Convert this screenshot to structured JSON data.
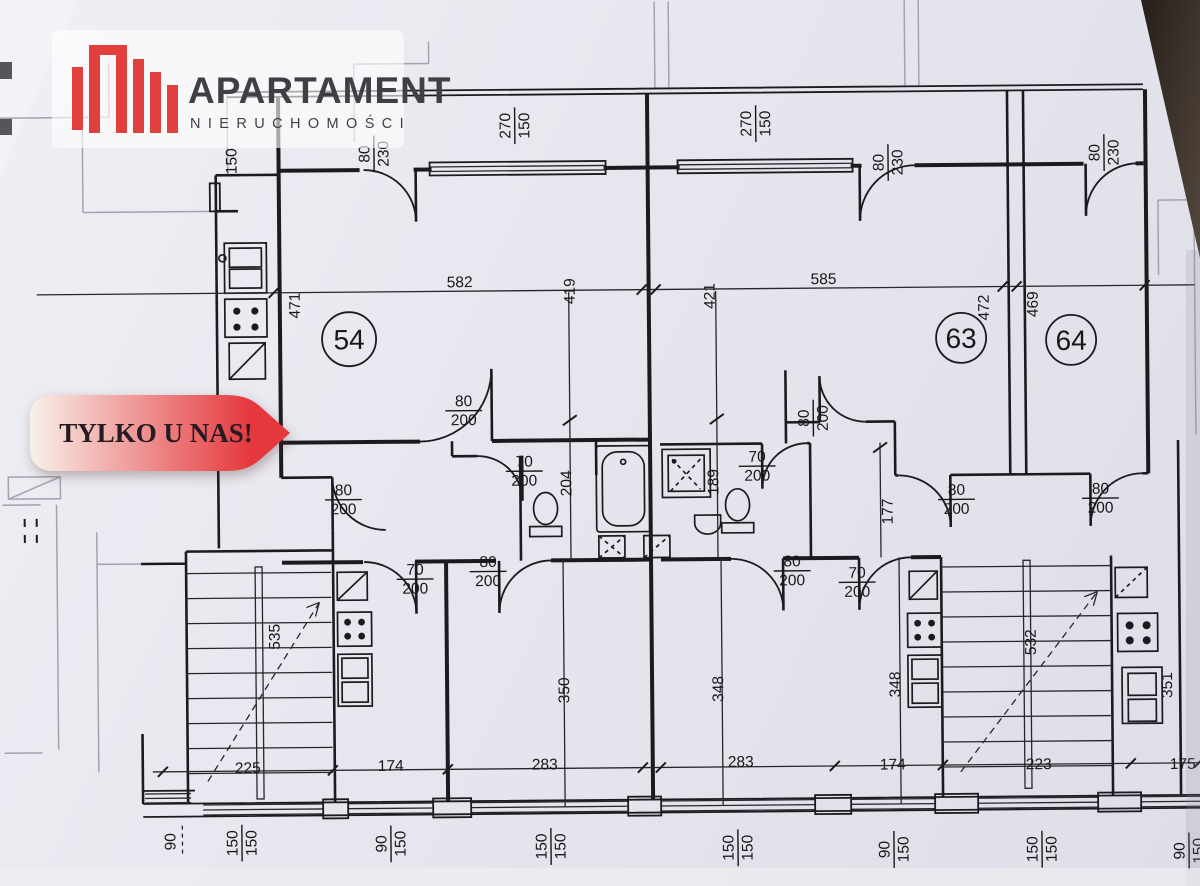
{
  "logo": {
    "title": "APARTAMENT",
    "subtitle": "NIERUCHOMOŚCI",
    "accent_color": "#e2403c",
    "text_color": "#3f3f44"
  },
  "badge": {
    "text": "TYLKO U NAS!",
    "gradient_start": "#f8f0ea",
    "gradient_end": "#e5383d",
    "text_color": "#241c22"
  },
  "rooms": [
    {
      "number": "54"
    },
    {
      "number": "63"
    },
    {
      "number": "64"
    }
  ],
  "ink_color": "#1b1b1f",
  "dimension_labels": [
    {
      "t": "80/230",
      "x": 376,
      "y": 152,
      "r": -90
    },
    {
      "t": "270/150",
      "x": 517,
      "y": 125,
      "r": -90
    },
    {
      "t": "270/150",
      "x": 758,
      "y": 125,
      "r": -90
    },
    {
      "t": "80/230",
      "x": 890,
      "y": 165,
      "r": -90
    },
    {
      "t": "80/230",
      "x": 1106,
      "y": 157,
      "r": -90
    },
    {
      "t": "150",
      "x": 233,
      "y": 158,
      "r": -90
    },
    {
      "t": "471",
      "x": 295,
      "y": 303,
      "r": -90
    },
    {
      "t": "582",
      "x": 461,
      "y": 280,
      "r": 0
    },
    {
      "t": "419",
      "x": 570,
      "y": 291,
      "r": -90
    },
    {
      "t": "421",
      "x": 710,
      "y": 297,
      "r": -90
    },
    {
      "t": "585",
      "x": 825,
      "y": 280,
      "r": 0
    },
    {
      "t": "472",
      "x": 984,
      "y": 311,
      "r": -90
    },
    {
      "t": "469",
      "x": 1033,
      "y": 308,
      "r": -90
    },
    {
      "t": "80/200",
      "x": 464,
      "y": 409,
      "r": 0
    },
    {
      "t": "80/200",
      "x": 813,
      "y": 420,
      "r": -90
    },
    {
      "t": "70/200",
      "x": 524,
      "y": 470,
      "r": 0
    },
    {
      "t": "70/200",
      "x": 757,
      "y": 467,
      "r": 0
    },
    {
      "t": "204",
      "x": 565,
      "y": 483,
      "r": -90
    },
    {
      "t": "189",
      "x": 712,
      "y": 483,
      "r": -90
    },
    {
      "t": "80/200",
      "x": 343,
      "y": 497,
      "r": 0
    },
    {
      "t": "80/200",
      "x": 956,
      "y": 502,
      "r": 0
    },
    {
      "t": "80/200",
      "x": 1100,
      "y": 502,
      "r": 0
    },
    {
      "t": "177",
      "x": 886,
      "y": 514,
      "r": -90
    },
    {
      "t": "70/200",
      "x": 414,
      "y": 577,
      "r": 0
    },
    {
      "t": "80/200",
      "x": 487,
      "y": 570,
      "r": 0
    },
    {
      "t": "80/200",
      "x": 791,
      "y": 572,
      "r": 0
    },
    {
      "t": "70/200",
      "x": 856,
      "y": 584,
      "r": 0
    },
    {
      "t": "535",
      "x": 272,
      "y": 634,
      "r": -90
    },
    {
      "t": "350",
      "x": 561,
      "y": 690,
      "r": -90
    },
    {
      "t": "348",
      "x": 715,
      "y": 690,
      "r": -90
    },
    {
      "t": "348",
      "x": 892,
      "y": 687,
      "r": -90
    },
    {
      "t": "532",
      "x": 1028,
      "y": 646,
      "r": -90
    },
    {
      "t": "351",
      "x": 1164,
      "y": 690,
      "r": -90
    },
    {
      "t": "225",
      "x": 245,
      "y": 764,
      "r": 0
    },
    {
      "t": "174",
      "x": 388,
      "y": 763,
      "r": 0
    },
    {
      "t": "283",
      "x": 542,
      "y": 763,
      "r": 0
    },
    {
      "t": "283",
      "x": 738,
      "y": 762,
      "r": 0
    },
    {
      "t": "174",
      "x": 890,
      "y": 766,
      "r": 0
    },
    {
      "t": "223",
      "x": 1036,
      "y": 767,
      "r": 0
    },
    {
      "t": "175",
      "x": 1180,
      "y": 768,
      "r": 0
    },
    {
      "t": "90",
      "x": 166,
      "y": 838,
      "r": -90
    },
    {
      "t": "150/150",
      "x": 238,
      "y": 840,
      "r": -90
    },
    {
      "t": "90/150",
      "x": 387,
      "y": 842,
      "r": -90
    },
    {
      "t": "150/150",
      "x": 547,
      "y": 846,
      "r": -90
    },
    {
      "t": "150/150",
      "x": 734,
      "y": 849,
      "r": -90
    },
    {
      "t": "90/150",
      "x": 890,
      "y": 852,
      "r": -90
    },
    {
      "t": "150/150",
      "x": 1038,
      "y": 853,
      "r": -90
    },
    {
      "t": "90/150",
      "x": 1185,
      "y": 856,
      "r": -90
    }
  ]
}
